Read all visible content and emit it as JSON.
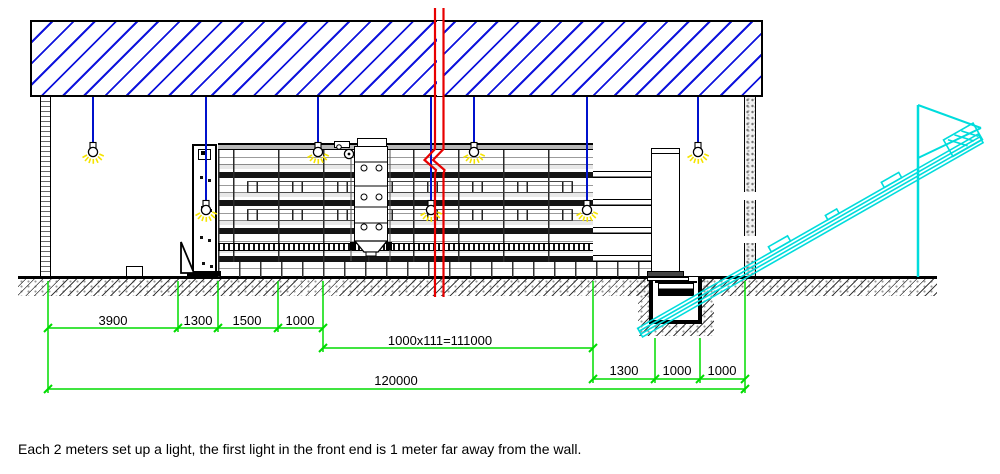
{
  "caption": "Each 2 meters set up a light, the first light in the front end is 1 meter far away from the wall.",
  "dimensions": {
    "row1": [
      "3900",
      "1300",
      "1500",
      "1000"
    ],
    "row2": [
      "1000x111=111000"
    ],
    "row3": [
      "1300",
      "1000",
      "1000"
    ],
    "total": "120000"
  },
  "lights": {
    "count": 7
  },
  "colors": {
    "roof_hatch": "#0f14dd",
    "light_wire": "#0011cc",
    "bulb_glow": "#f5e400",
    "break_line": "#e80000",
    "dimension": "#00dc00",
    "conveyor": "#00dcdc"
  }
}
